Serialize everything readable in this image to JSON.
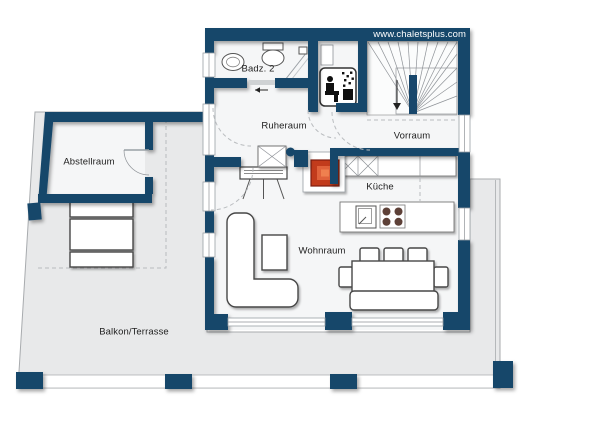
{
  "watermark": "www.chaletsplus.com",
  "rooms": {
    "badz2": {
      "label": "Badz. 2"
    },
    "ruheraum": {
      "label": "Ruheraum"
    },
    "vorraum": {
      "label": "Vorraum"
    },
    "abstellraum": {
      "label": "Abstellraum"
    },
    "kueche": {
      "label": "Küche"
    },
    "wohnraum": {
      "label": "Wohnraum"
    },
    "balkon": {
      "label": "Balkon/Terrasse"
    }
  },
  "colors": {
    "wall": "#17466b",
    "terrace": "#e8e9ea",
    "room": "#f5f6f7",
    "stove": "#c23a1e",
    "burner": "#5d4037"
  }
}
